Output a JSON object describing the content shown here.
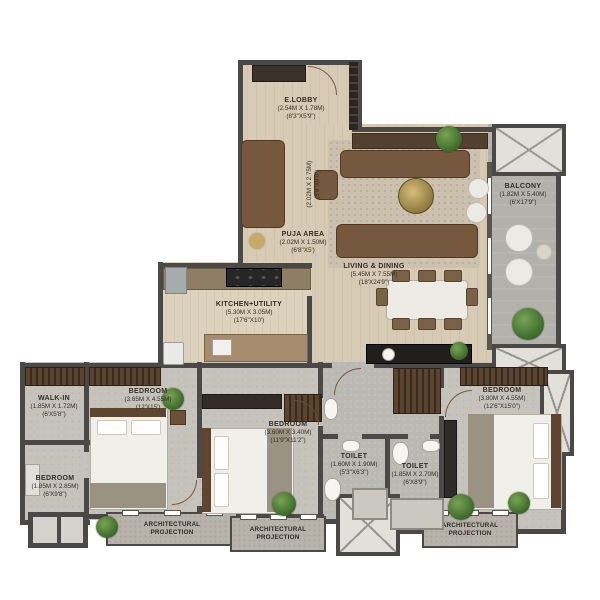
{
  "rooms": {
    "elobby": {
      "name": "E.LOBBY",
      "metric": "(2.54M X 1.78M)",
      "imperial": "(8'3\"X5'9\")"
    },
    "foyer": {
      "metric": "(2.02M X 2.75M)",
      "imperial": "(6'8\"X9'0\")"
    },
    "puja": {
      "name": "PUJA AREA",
      "metric": "(2.02M X 1.50M)",
      "imperial": "(6'8\"X5')"
    },
    "living_dining": {
      "name": "LIVING & DINING",
      "metric": "(5.45M X 7.55M)",
      "imperial": "(18'X24'9\")"
    },
    "kitchen": {
      "name": "KITCHEN+UTILITY",
      "metric": "(5.30M X 3.05M)",
      "imperial": "(17'6\"X10')"
    },
    "balcony": {
      "name": "BALCONY",
      "metric": "(1.82M X 5.40M)",
      "imperial": "(6'X17'9\")"
    },
    "walk_in": {
      "name": "WALK-IN",
      "metric": "(1.85M X 1.72M)",
      "imperial": "(6'X5'8\")"
    },
    "bedroom_compact": {
      "name": "BEDROOM",
      "metric": "(1.85M X 2.85M)",
      "imperial": "(6'X9'8\")"
    },
    "bedroom_left": {
      "name": "BEDROOM",
      "metric": "(3.65M X 4.55M)",
      "imperial": "(12'X15')"
    },
    "bedroom_mid": {
      "name": "BEDROOM",
      "metric": "(3.60M X 3.40M)",
      "imperial": "(11'9\"X11'2\")"
    },
    "toilet_common": {
      "name": "TOILET",
      "metric": "(1.60M X 1.90M)",
      "imperial": "(5'3\"X6'3\")"
    },
    "toilet_master": {
      "name": "TOILET",
      "metric": "(1.85M X 2.70M)",
      "imperial": "(6'X8'9\")"
    },
    "bedroom_master": {
      "name": "BEDROOM",
      "metric": "(3.80M X 4.55M)",
      "imperial": "(12'6\"X15'0\")"
    },
    "architectural_projection": {
      "name": "ARCHITECTURAL PROJECTION"
    }
  },
  "colors": {
    "wall": "#4b4947",
    "wood_floor": "#d8cbb5",
    "gray_floor": "#c6c3bc",
    "balcony_floor": "#b2b1ac",
    "hatch_fill": "#e1e0db",
    "plant_green": "#42702f"
  }
}
